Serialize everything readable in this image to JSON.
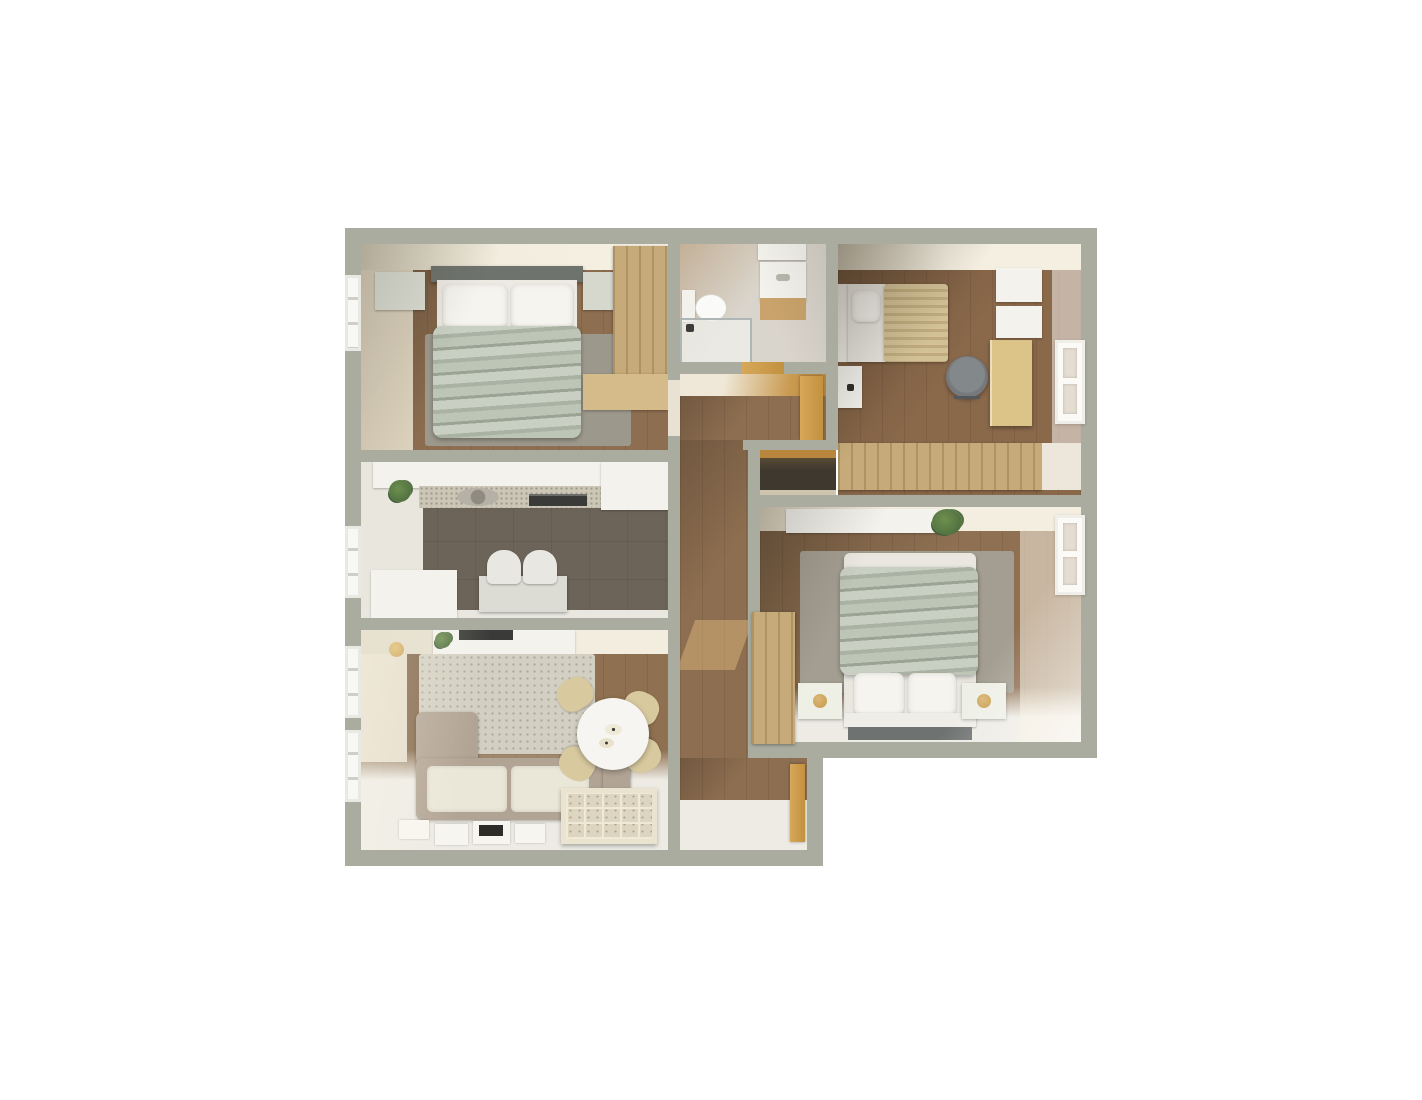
{
  "scene": {
    "type": "3d-apartment-floor-plan-render",
    "view": "top-down",
    "background": "#ffffff",
    "rooms": [
      {
        "name": "bedroom-1",
        "position": "top-left",
        "furniture": [
          "double-bed-sage-blanket",
          "headboard",
          "two-nightstands",
          "gray-rug",
          "wood-wardrobe",
          "window"
        ]
      },
      {
        "name": "kitchen",
        "position": "middle-left",
        "furniture": [
          "counter-with-sink-and-hood",
          "upper-cabinets",
          "plant",
          "island-cabinet",
          "small-table",
          "two-chairs",
          "window"
        ]
      },
      {
        "name": "living-room",
        "position": "bottom-left",
        "furniture": [
          "corner-sofa",
          "textured-rug",
          "round-dining-table",
          "four-tan-chairs",
          "cube-shelf-unit",
          "sideboard-with-tv",
          "wall-lamp",
          "floor-posters",
          "two-windows"
        ]
      },
      {
        "name": "bathroom",
        "position": "top-center",
        "furniture": [
          "toilet",
          "shower-enclosure",
          "vanity-sink",
          "wall-cabinet"
        ]
      },
      {
        "name": "bedroom-2",
        "position": "top-right",
        "furniture": [
          "single-bed-striped-blanket",
          "nightstand",
          "desk",
          "office-chair",
          "wall-shelves",
          "long-wardrobe",
          "window"
        ]
      },
      {
        "name": "master-bedroom",
        "position": "right",
        "furniture": [
          "double-bed-sage-blanket",
          "two-nightstands-with-lamps",
          "bench",
          "rug",
          "tall-wardrobe",
          "wall-shelf",
          "plant",
          "window"
        ]
      },
      {
        "name": "hallway",
        "position": "center",
        "furniture": [
          "open-doors",
          "closet-niche",
          "sunlight-patches"
        ]
      },
      {
        "name": "entry",
        "position": "bottom-center",
        "furniture": [
          "entry-door"
        ]
      }
    ]
  },
  "palette": {
    "wall": "#a9ac9f",
    "cream": "#f1ecdf",
    "creamShadow": "#d6cfbc",
    "whiteSurface": "#f3f2ed",
    "woodFloor": "#8d6e50",
    "kitchenFloor": "#6d6459",
    "tileFloor": "#dad5cc",
    "whiteFloor": "#edebe4",
    "woodFurniture": "#c6aa79",
    "deskWood": "#dcc488",
    "doorWood": "#c2913f",
    "sage": "#bcc4b6",
    "beigeBlanket": "#cdb98e",
    "sofaBeige": "#b2a494",
    "cushionCream": "#eae6d8",
    "rugGray": "#9c988c",
    "rugLight": "#d3d0c3",
    "rugMaster": "#a39e91",
    "kallaxCream": "#e9e3d0",
    "chairTan": "#d8c99f",
    "officeChair": "#75797c",
    "headboardDark": "#6f736d",
    "benchDark": "#6e7270",
    "tvBlack": "#3a3a38",
    "plantGreen": "#4f7040",
    "lampGold": "#c49a4a",
    "glass": "#aeb6b6",
    "alcoveDark": "#3e382f"
  }
}
